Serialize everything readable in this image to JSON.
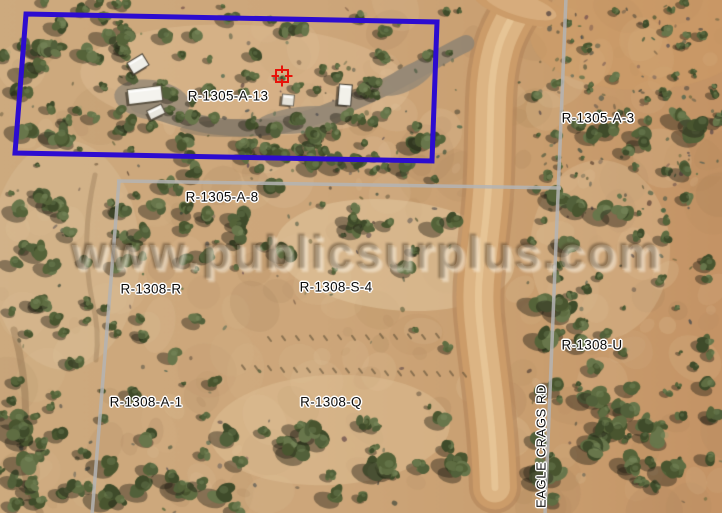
{
  "map": {
    "watermark": "www.publicsurplus.com",
    "highlight_color": "#2d0cd0",
    "boundary_color": "#b4b4b4",
    "marker_color": "#e81309",
    "parcel_labels": [
      {
        "text": "R-1305-A-13",
        "x": 228,
        "y": 96
      },
      {
        "text": "R-1305-A-3",
        "x": 598,
        "y": 118
      },
      {
        "text": "R-1305-A-8",
        "x": 222,
        "y": 197
      },
      {
        "text": "R-1308-R",
        "x": 151,
        "y": 289
      },
      {
        "text": "R-1308-S-4",
        "x": 336,
        "y": 287
      },
      {
        "text": "R-1308-U",
        "x": 592,
        "y": 345
      },
      {
        "text": "R-1308-A-1",
        "x": 146,
        "y": 402
      },
      {
        "text": "R-1308-Q",
        "x": 331,
        "y": 402
      }
    ],
    "road_label": {
      "text": "EAGLE CRAGS RD",
      "x": 541,
      "y": 446,
      "rotation_deg": -90
    }
  }
}
